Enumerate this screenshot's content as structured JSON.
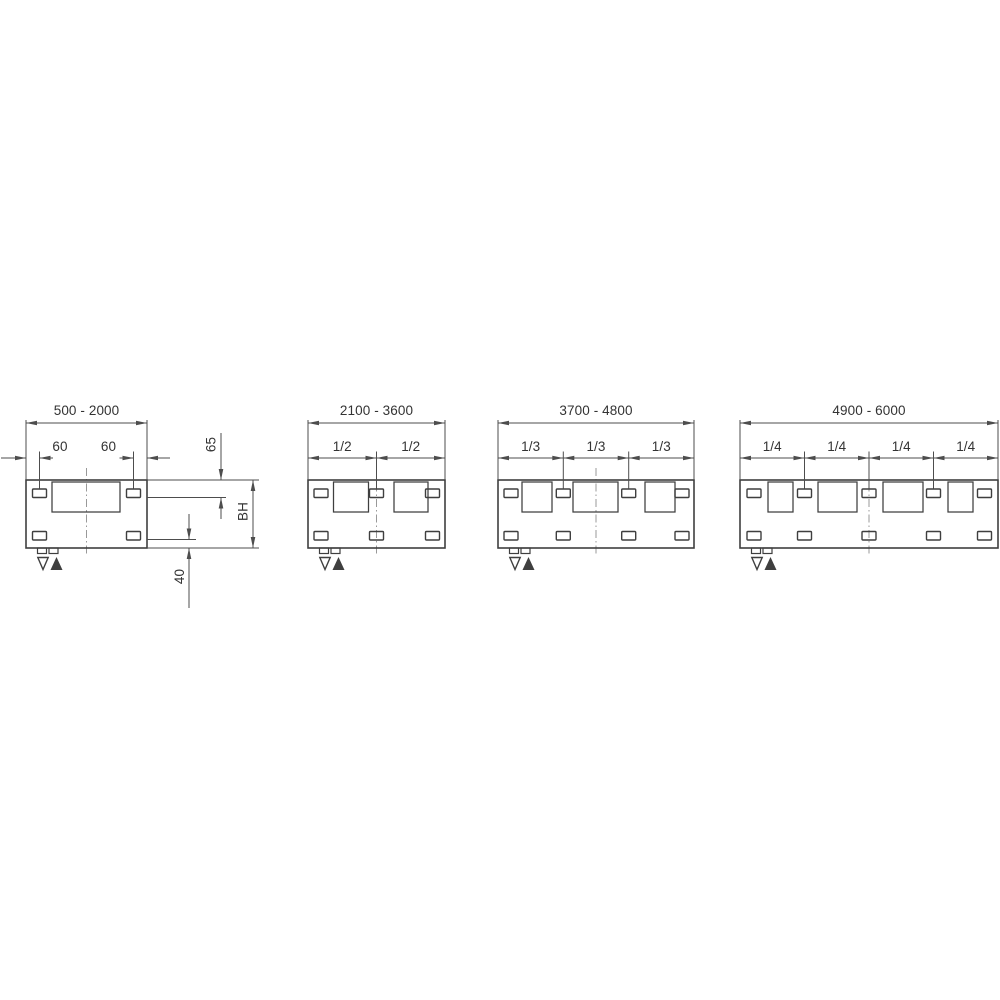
{
  "diagram": {
    "kind": "technical-drawing-mounting-dimensions",
    "description": "Four panel variants with bracket mounting positions for length ranges",
    "colors": {
      "background": "#ffffff",
      "line": "#3f3f3f",
      "dim_line": "#4d4d4d",
      "centerline": "#999999",
      "text": "#333333"
    },
    "geometry": {
      "dim_overall_y": 423,
      "dim_sub_y": 458,
      "range_label_cy": 410.5,
      "sub_label_cy": 446.5,
      "ext_top": 420,
      "tick_top": 451.5,
      "tick_bottom": 488.5,
      "rect_top": 480,
      "rect_bottom": 548,
      "inner_top": 482,
      "inner_h": 30,
      "slot_w": 14,
      "slot_h": 8.5,
      "top_slot_y": 489,
      "bottom_slot_y": 531.5,
      "tab_w": 9,
      "tab_h": 5.5,
      "tab_offsets": [
        11.5,
        23
      ],
      "tri_open_dx": 17,
      "tri_fill_dx": 30.5,
      "tri_top": 557.5,
      "tri_bottom": 570,
      "centerline_top": 468,
      "centerline_bottom": 556
    },
    "symbols": {
      "flow_open_triangle": "▽",
      "return_filled_triangle": "▲"
    },
    "panels": [
      {
        "name": "range-500-2000",
        "range_label": "500 - 2000",
        "x": 26,
        "width": 121,
        "dividers": [],
        "segment_labels": [],
        "top_slots": [
          13.5,
          107.5
        ],
        "bottom_slots": [
          13.5,
          107.5
        ],
        "inner_rects": [
          {
            "x": 26,
            "w": 68
          }
        ],
        "offset_dims": {
          "labels": [
            "60",
            "60"
          ],
          "label_x": [
            60,
            108.5
          ],
          "tick_x": [
            39.5,
            133.5
          ],
          "segments": [
            {
              "line": [
                1,
                26
              ],
              "tip": 26,
              "dir": "right"
            },
            {
              "line": [
                39.5,
                53
              ],
              "tip": 39.5,
              "dir": "left"
            },
            {
              "line": [
                119.5,
                133.5
              ],
              "tip": 133.5,
              "dir": "right"
            },
            {
              "line": [
                147,
                170
              ],
              "tip": 147,
              "dir": "left"
            }
          ]
        },
        "ref_lines": [
          {
            "y": 480,
            "x1": 147,
            "x2": 259
          },
          {
            "y": 497.5,
            "x1": 147,
            "x2": 226
          },
          {
            "y": 539.5,
            "x1": 147,
            "x2": 196
          },
          {
            "y": 548,
            "x1": 147,
            "x2": 259
          }
        ],
        "vertical_dims": [
          {
            "label": "65",
            "x": 221,
            "span": [
              480,
              497.5
            ],
            "arrows": "outside",
            "tails": [
              433,
              519
            ],
            "label_pos": [
              211,
              444.5
            ]
          },
          {
            "label": "BH",
            "x": 253,
            "span": [
              480,
              548
            ],
            "arrows": "inside",
            "label_pos": [
              243,
              511.5
            ]
          },
          {
            "label": "40",
            "x": 189,
            "span": [
              539.5,
              548
            ],
            "arrows": "outside",
            "tails": [
              514,
              608
            ],
            "label_pos": [
              179.5,
              576.5
            ]
          }
        ]
      },
      {
        "name": "range-2100-3600",
        "range_label": "2100 - 3600",
        "x": 308,
        "width": 137,
        "dividers": [
          68.5
        ],
        "segment_labels": [
          "1/2",
          "1/2"
        ],
        "top_slots": [
          13,
          68.5,
          124.5
        ],
        "bottom_slots": [
          13,
          68.5,
          124.5
        ],
        "inner_rects": [
          {
            "x": 25.5,
            "w": 35
          },
          {
            "x": 86,
            "w": 34
          }
        ]
      },
      {
        "name": "range-3700-4800",
        "range_label": "3700 - 4800",
        "x": 498,
        "width": 196,
        "dividers": [
          65.3,
          130.7
        ],
        "segment_labels": [
          "1/3",
          "1/3",
          "1/3"
        ],
        "top_slots": [
          13,
          65.3,
          130.7,
          184
        ],
        "bottom_slots": [
          13,
          65.3,
          130.7,
          184
        ],
        "inner_rects": [
          {
            "x": 24,
            "w": 30
          },
          {
            "x": 75,
            "w": 45
          },
          {
            "x": 147,
            "w": 30
          }
        ]
      },
      {
        "name": "range-4900-6000",
        "range_label": "4900 - 6000",
        "x": 740,
        "width": 258,
        "dividers": [
          64.5,
          129,
          193.5
        ],
        "segment_labels": [
          "1/4",
          "1/4",
          "1/4",
          "1/4"
        ],
        "top_slots": [
          14,
          64.5,
          129,
          193.5,
          244.5
        ],
        "bottom_slots": [
          14,
          64.5,
          129,
          193.5,
          244.5
        ],
        "inner_rects": [
          {
            "x": 28,
            "w": 25
          },
          {
            "x": 78,
            "w": 39
          },
          {
            "x": 143,
            "w": 40
          },
          {
            "x": 208,
            "w": 25
          }
        ]
      }
    ]
  }
}
